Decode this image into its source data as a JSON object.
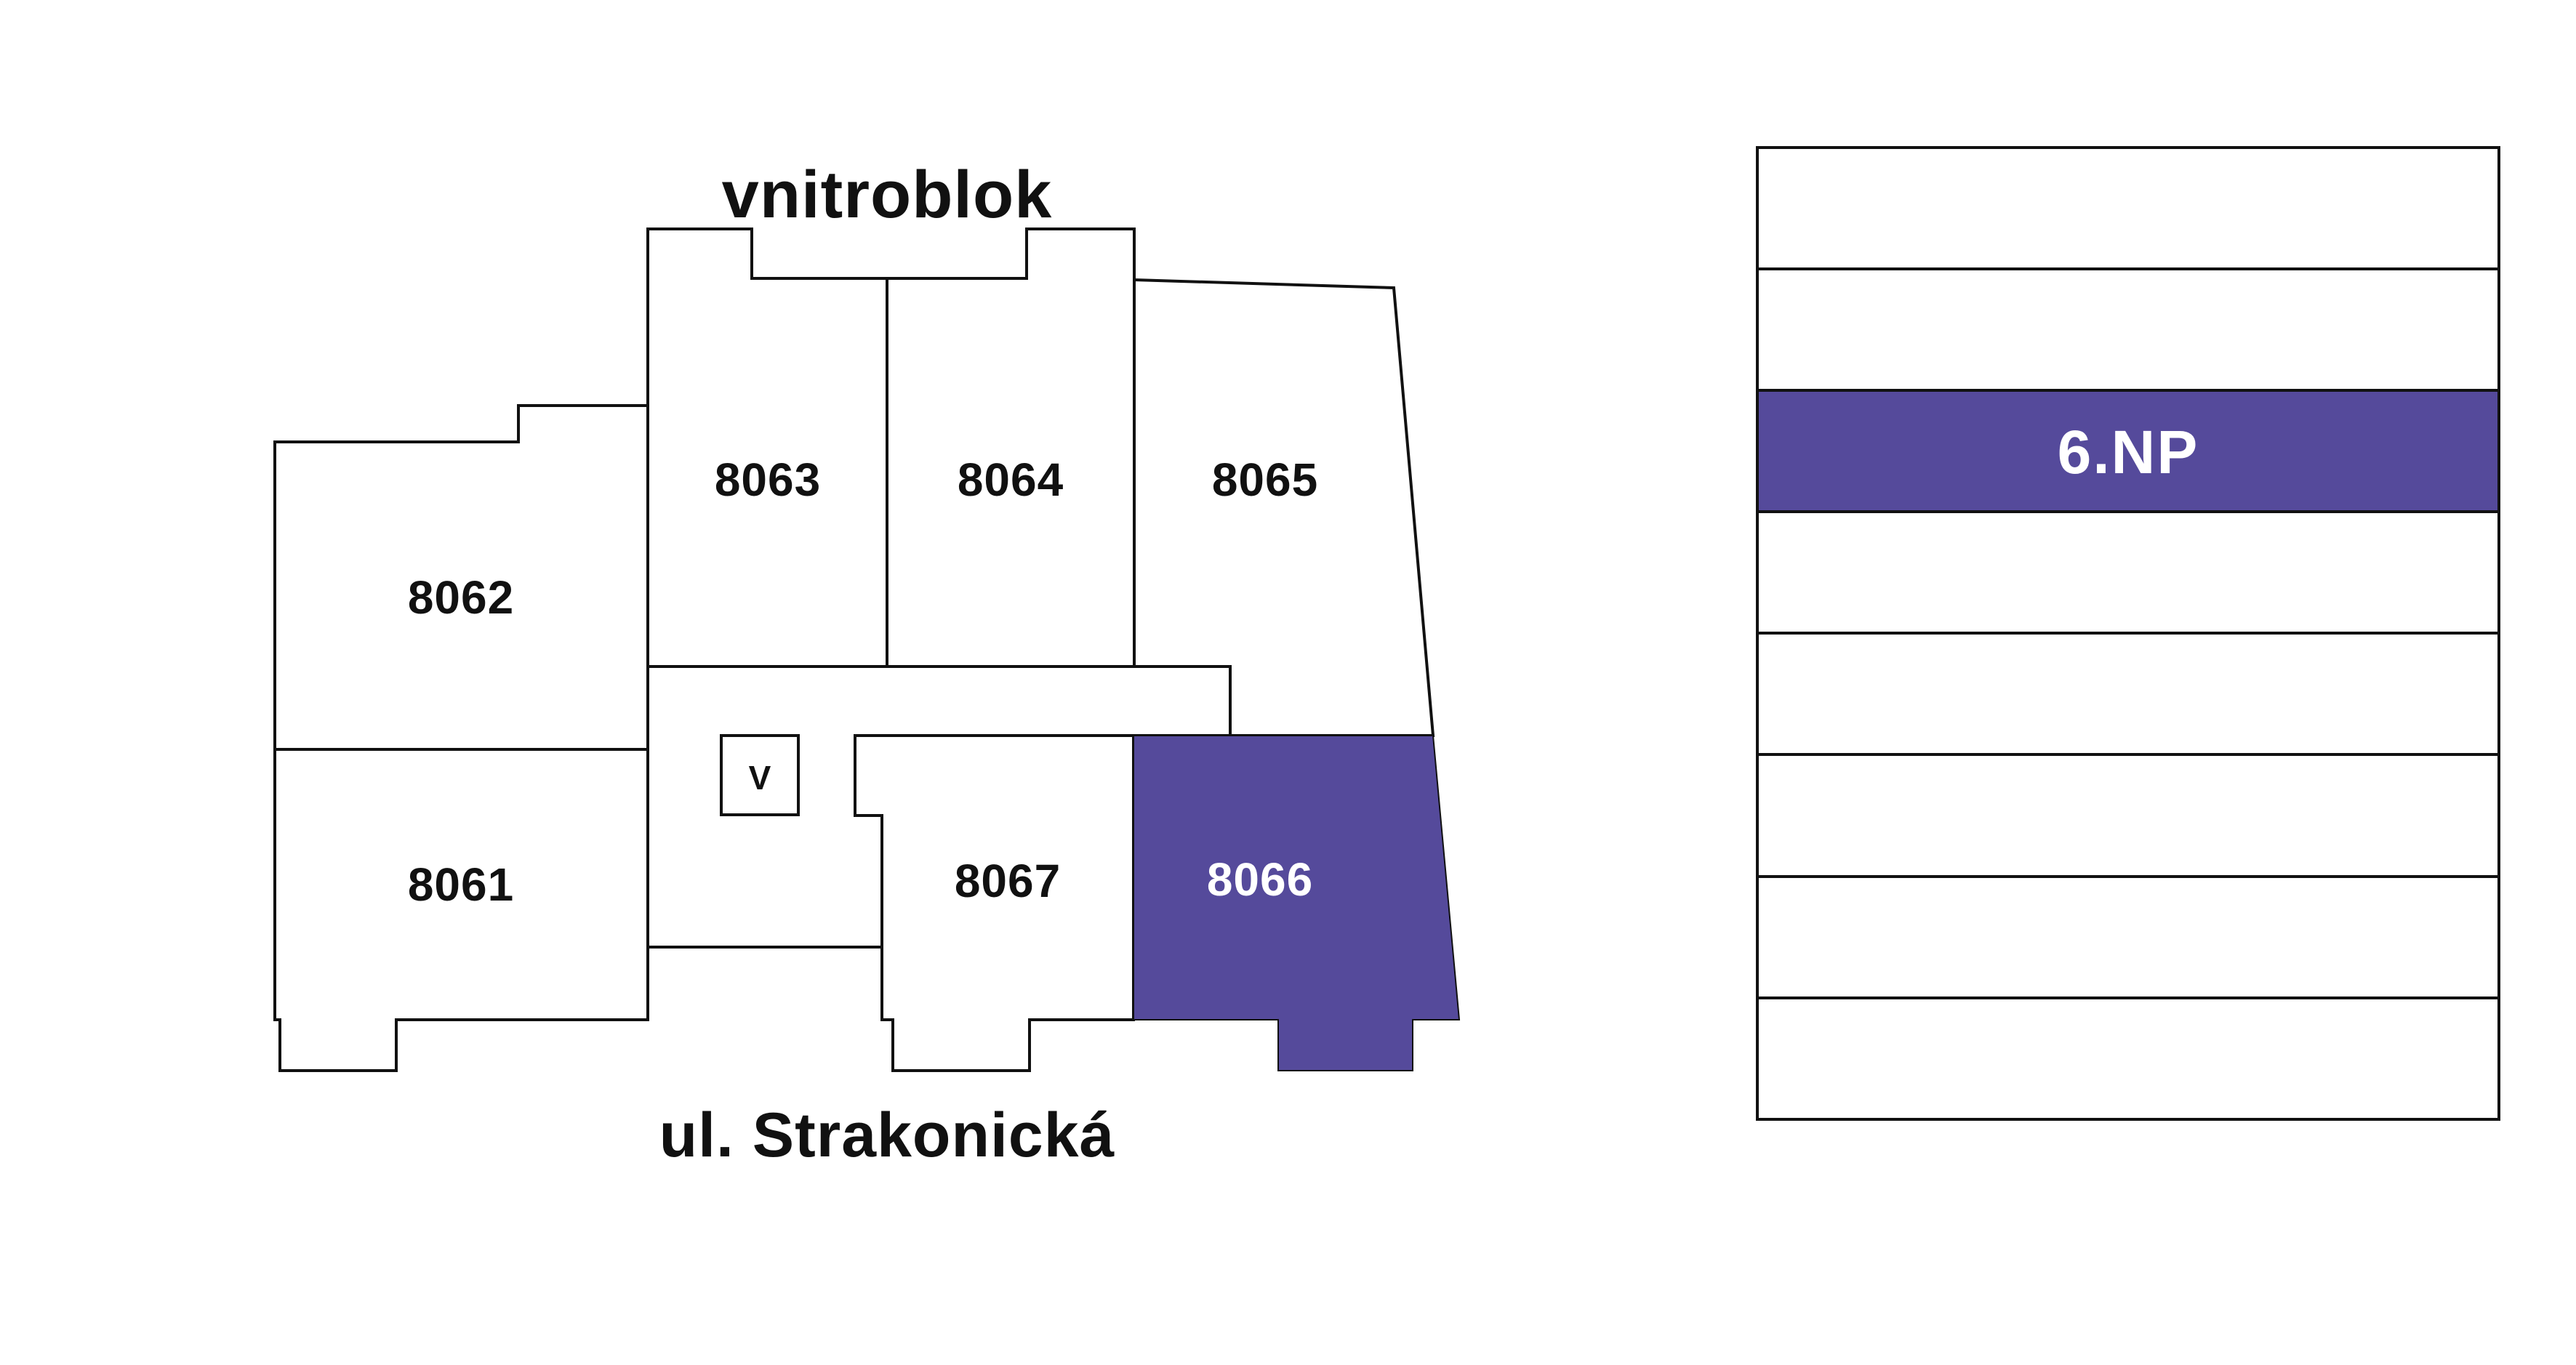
{
  "titles": {
    "top": "vnitroblok",
    "bottom": "ul. Strakonická"
  },
  "plan": {
    "units": [
      {
        "id": "8061",
        "label": "8061",
        "selected": false
      },
      {
        "id": "8062",
        "label": "8062",
        "selected": false
      },
      {
        "id": "8063",
        "label": "8063",
        "selected": false
      },
      {
        "id": "8064",
        "label": "8064",
        "selected": false
      },
      {
        "id": "8065",
        "label": "8065",
        "selected": false
      },
      {
        "id": "8066",
        "label": "8066",
        "selected": true
      },
      {
        "id": "8067",
        "label": "8067",
        "selected": false
      }
    ],
    "elevator_label": "V"
  },
  "floor_stack": {
    "selected_floor": "6.NP",
    "floors": [
      {
        "label": "",
        "selected": false
      },
      {
        "label": "",
        "selected": false
      },
      {
        "label": "6.NP",
        "selected": true
      },
      {
        "label": "",
        "selected": false
      },
      {
        "label": "",
        "selected": false
      },
      {
        "label": "",
        "selected": false
      },
      {
        "label": "",
        "selected": false
      },
      {
        "label": "",
        "selected": false
      }
    ]
  },
  "colors": {
    "accent": "#554A9B",
    "accent_text": "#FFFFFF",
    "line": "#111111",
    "ink": "#111111",
    "bg": "#FFFFFF"
  }
}
